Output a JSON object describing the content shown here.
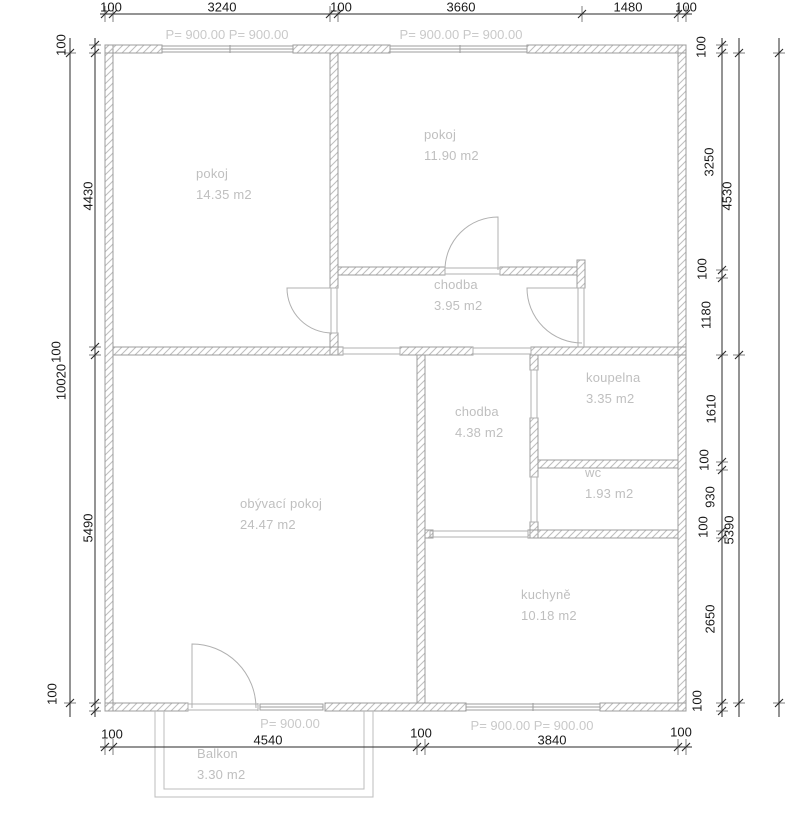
{
  "rooms": {
    "pokoj1": {
      "name": "pokoj",
      "area": "14.35 m2"
    },
    "pokoj2": {
      "name": "pokoj",
      "area": "11.90 m2"
    },
    "chodba1": {
      "name": "chodba",
      "area": "3.95 m2"
    },
    "chodba2": {
      "name": "chodba",
      "area": "4.38 m2"
    },
    "koupelna": {
      "name": "koupelna",
      "area": "3.35 m2"
    },
    "wc": {
      "name": "wc",
      "area": "1.93 m2"
    },
    "obyvaci": {
      "name": "obývací pokoj",
      "area": "24.47 m2"
    },
    "kuchyne": {
      "name": "kuchyně",
      "area": "10.18 m2"
    },
    "balkon": {
      "name": "Balkon",
      "area": "3.30 m2"
    }
  },
  "parapets": {
    "top_left": "P= 900.00 P= 900.00",
    "top_right": "P= 900.00 P= 900.00",
    "bottom_left": "P= 900.00",
    "bottom_right": "P= 900.00 P= 900.00"
  },
  "dims": {
    "top": [
      "100",
      "3240",
      "100",
      "3660",
      "1480",
      "100"
    ],
    "bottom": [
      "100",
      "4540",
      "100",
      "3840",
      "100"
    ],
    "left": [
      "100",
      "4430",
      "100",
      "5490",
      "100"
    ],
    "left_total": "10020",
    "right": [
      "100",
      "3250",
      "100",
      "1180",
      "1610",
      "100",
      "930",
      "100",
      "2650",
      "100"
    ],
    "right_spans": [
      "4530",
      "5390"
    ]
  },
  "palette": {
    "background": "#ffffff",
    "wall_outline": "#9c9c9c",
    "wall_hatch": "#bdbdbd",
    "thin_plan_line": "#b0b0b0",
    "dimension_line": "#2a2a2a",
    "dimension_text": "#1a1a1a",
    "room_text": "#bfbfbf",
    "parapet_text": "#c9c9c9"
  }
}
